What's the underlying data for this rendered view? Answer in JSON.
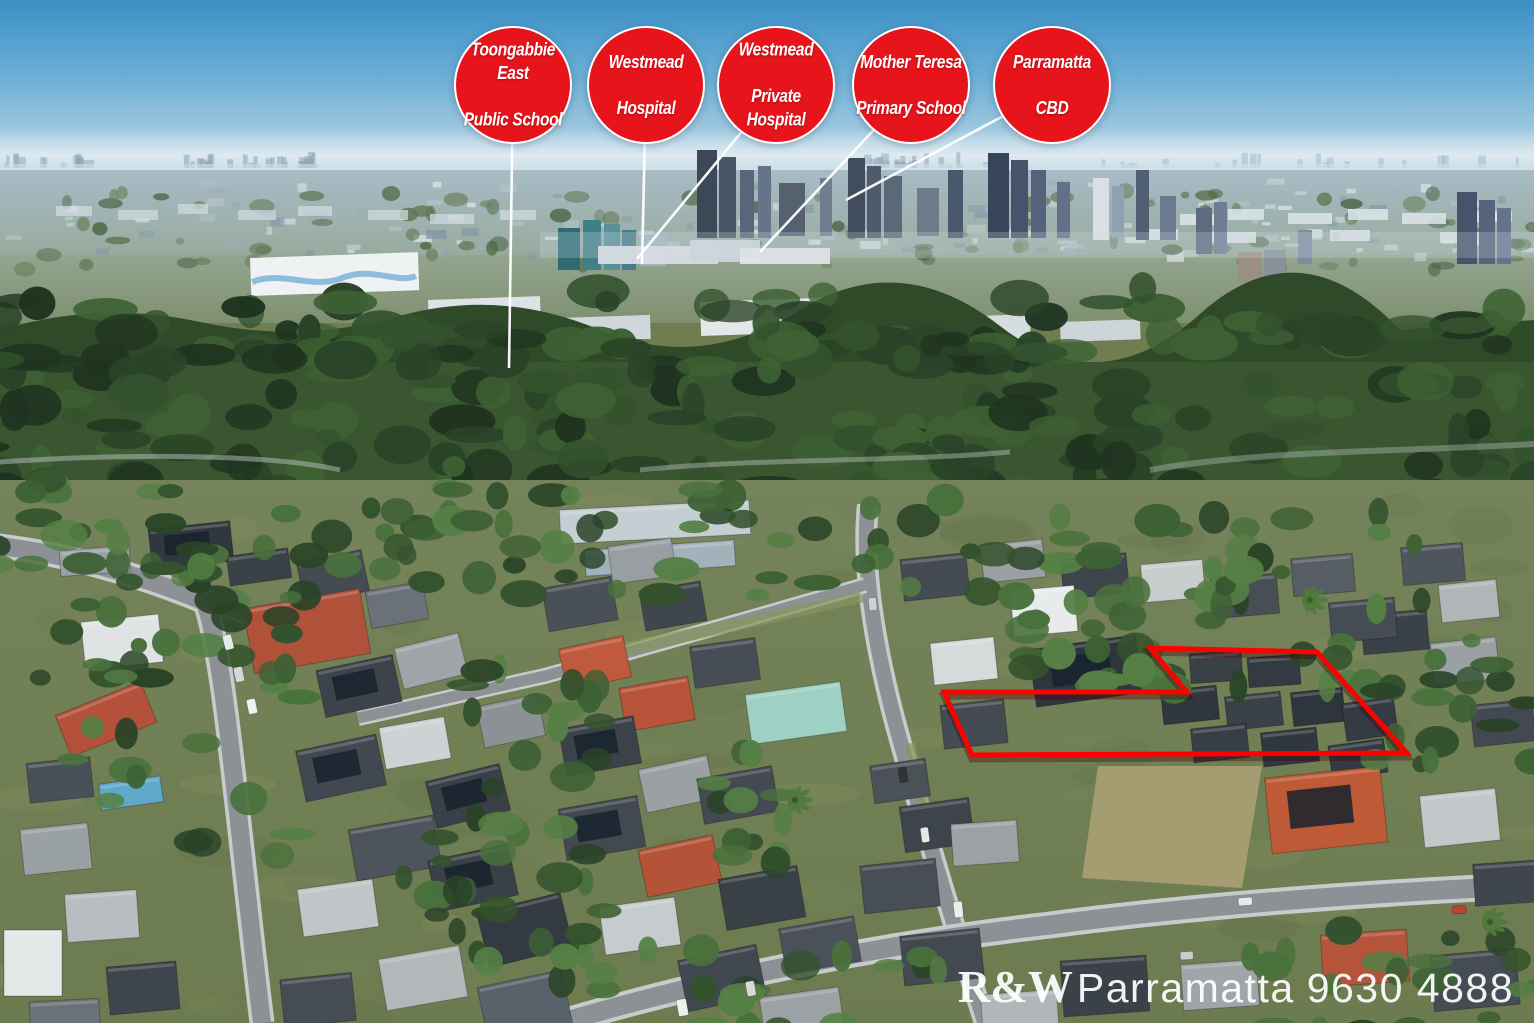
{
  "badges": [
    {
      "line1": "Toongabbie East",
      "line2": "Public School"
    },
    {
      "line1": "Westmead",
      "line2": "Hospital"
    },
    {
      "line1": "Westmead",
      "line2": "Private Hospital"
    },
    {
      "line1": "Mother Teresa",
      "line2": "Primary School"
    },
    {
      "line1": "Parramatta",
      "line2": "CBD"
    }
  ],
  "watermark": {
    "brand": "R&W",
    "office": "Parramatta",
    "phone": "9630 4888"
  },
  "colors": {
    "badge_red": "#e8141c",
    "badge_border": "#ffffff",
    "property_outline": "#ff0000",
    "leader_line": "#ffffff",
    "watermark_text": "#ffffff"
  }
}
